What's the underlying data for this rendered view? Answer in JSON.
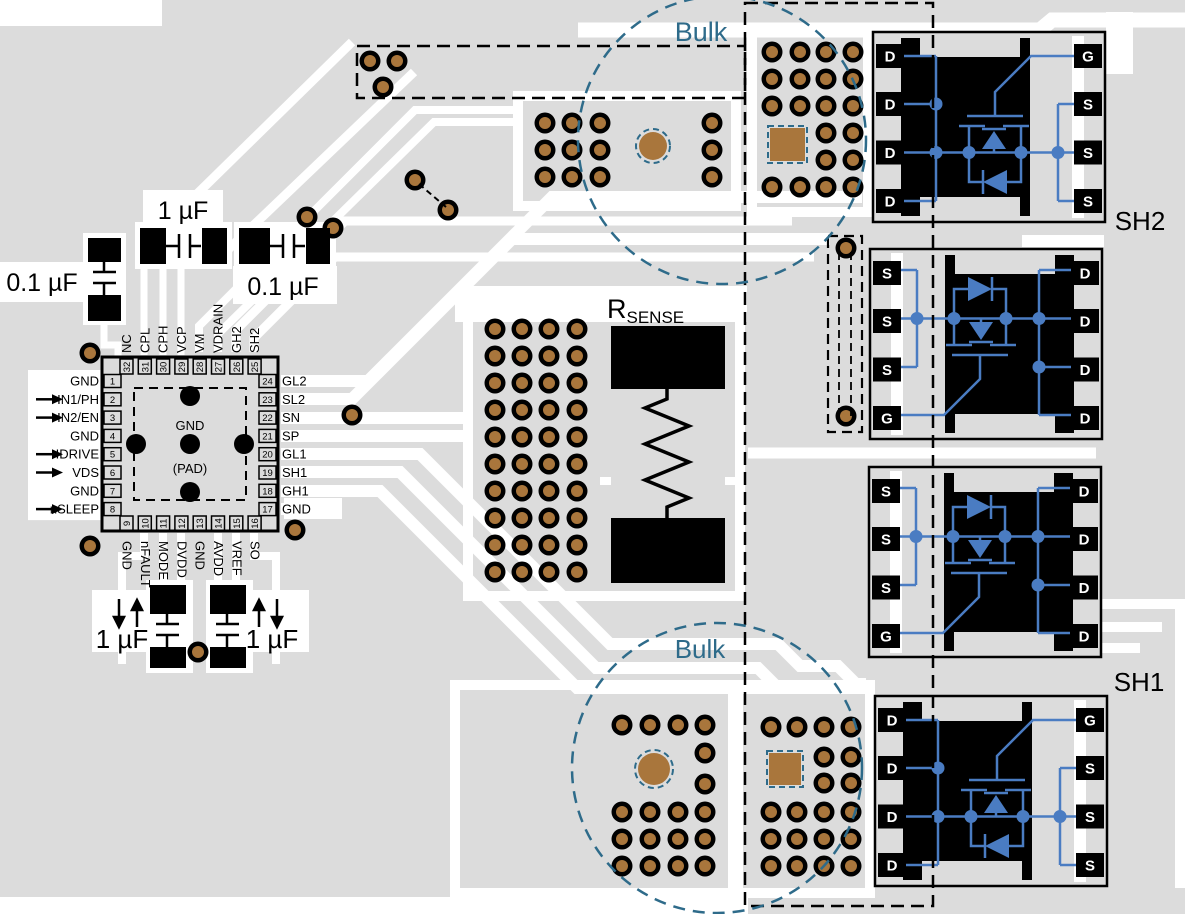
{
  "colors": {
    "board": "#dcdcdc",
    "trace": "#ffffff",
    "copper": "#a9763c",
    "pad_black": "#000000",
    "schematic_blue": "#4a7cc2",
    "bulk_teal": "#2e6b8a"
  },
  "labels": {
    "bulk_top": "Bulk",
    "bulk_bottom": "Bulk",
    "sh2": "SH2",
    "sh1": "SH1",
    "rsense_base": "R",
    "rsense_sub": "SENSE"
  },
  "capacitors": {
    "left_0_1uf": "0.1 µF",
    "top_1uf": "1 µF",
    "top_0_1uf": "0.1 µF",
    "bottom_left_1uf": "1 µF",
    "bottom_right_1uf": "1 µF"
  },
  "ic": {
    "pad_label_top": "GND",
    "pad_label_bottom": "(PAD)",
    "left_pins": [
      {
        "num": "1",
        "name": "GND",
        "arrow": false
      },
      {
        "num": "2",
        "name": "IN1/PH",
        "arrow": true
      },
      {
        "num": "3",
        "name": "IN2/EN",
        "arrow": true
      },
      {
        "num": "4",
        "name": "GND",
        "arrow": false
      },
      {
        "num": "5",
        "name": "IDRIVE",
        "arrow": true
      },
      {
        "num": "6",
        "name": "VDS",
        "arrow": true
      },
      {
        "num": "7",
        "name": "GND",
        "arrow": false
      },
      {
        "num": "8",
        "name": "nSLEEP",
        "arrow": true
      }
    ],
    "top_pins": [
      {
        "num": "32",
        "name": "NC"
      },
      {
        "num": "31",
        "name": "CPL"
      },
      {
        "num": "30",
        "name": "CPH"
      },
      {
        "num": "29",
        "name": "VCP"
      },
      {
        "num": "28",
        "name": "VM"
      },
      {
        "num": "27",
        "name": "VDRAIN"
      },
      {
        "num": "26",
        "name": "GH2"
      },
      {
        "num": "25",
        "name": "SH2"
      }
    ],
    "right_pins": [
      {
        "num": "24",
        "name": "GL2"
      },
      {
        "num": "23",
        "name": "SL2"
      },
      {
        "num": "22",
        "name": "SN"
      },
      {
        "num": "21",
        "name": "SP"
      },
      {
        "num": "20",
        "name": "GL1"
      },
      {
        "num": "19",
        "name": "SH1"
      },
      {
        "num": "18",
        "name": "GH1"
      },
      {
        "num": "17",
        "name": "GND"
      }
    ],
    "bottom_pins": [
      {
        "num": "9",
        "name": "GND"
      },
      {
        "num": "10",
        "name": "nFAULT"
      },
      {
        "num": "11",
        "name": "MODE"
      },
      {
        "num": "12",
        "name": "DVDD"
      },
      {
        "num": "13",
        "name": "GND"
      },
      {
        "num": "14",
        "name": "AVDD"
      },
      {
        "num": "15",
        "name": "VREF"
      },
      {
        "num": "16",
        "name": "SO"
      }
    ]
  },
  "mosfets": [
    {
      "id": "mosfet-top-right",
      "left_pins": [
        "D",
        "D",
        "D",
        "D"
      ],
      "right_pins": [
        "G",
        "S",
        "S",
        "S"
      ]
    },
    {
      "id": "mosfet-upper-middle",
      "left_pins": [
        "S",
        "S",
        "S",
        "G"
      ],
      "right_pins": [
        "D",
        "D",
        "D",
        "D"
      ]
    },
    {
      "id": "mosfet-lower-middle",
      "left_pins": [
        "S",
        "S",
        "S",
        "G"
      ],
      "right_pins": [
        "D",
        "D",
        "D",
        "D"
      ]
    },
    {
      "id": "mosfet-bottom-right",
      "left_pins": [
        "D",
        "D",
        "D",
        "D"
      ],
      "right_pins": [
        "G",
        "S",
        "S",
        "S"
      ]
    }
  ]
}
